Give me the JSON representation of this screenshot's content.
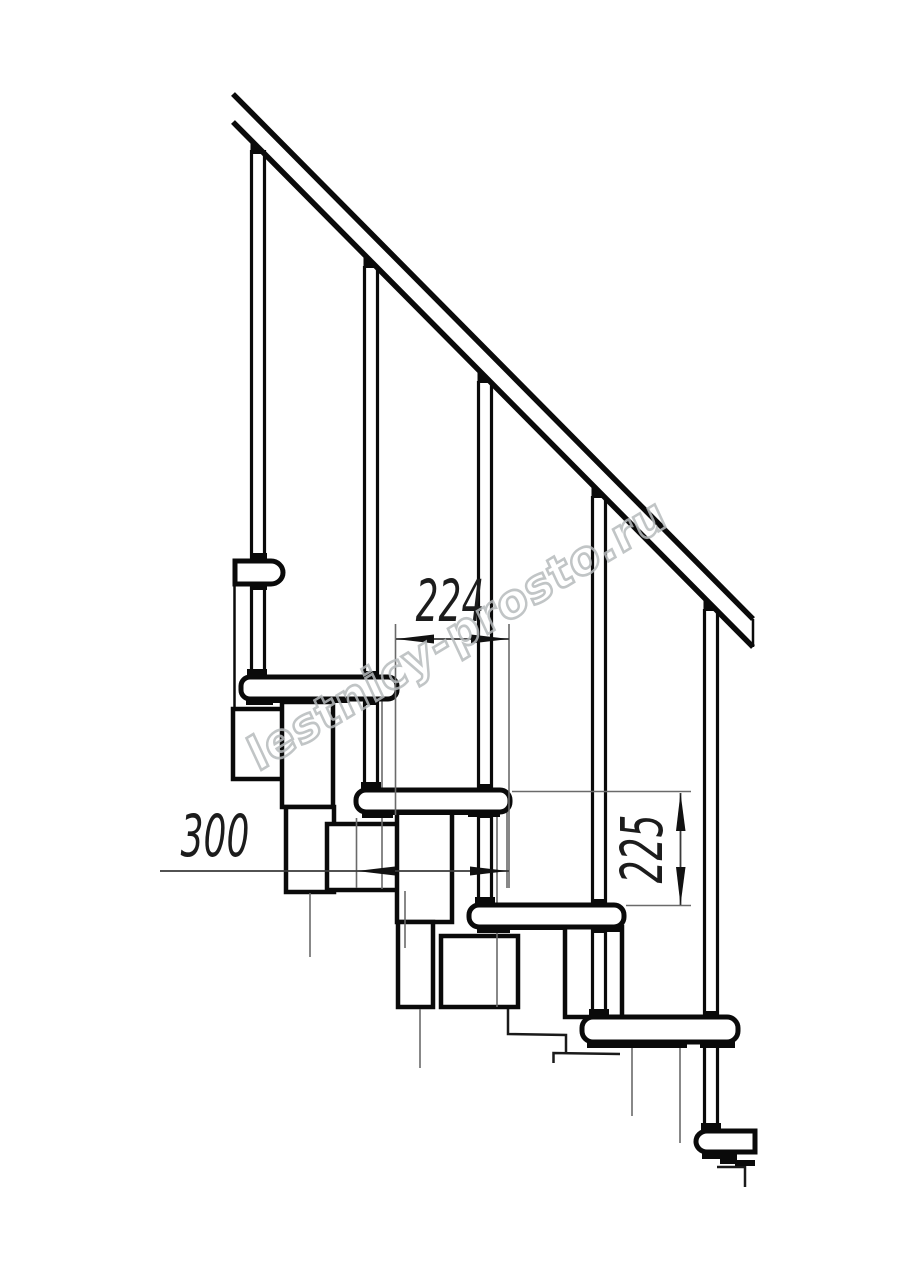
{
  "drawing": {
    "dimensions": {
      "step_offset": {
        "value": "224"
      },
      "tread_depth": {
        "value": "300"
      },
      "riser_height": {
        "value": "225"
      }
    },
    "watermark": {
      "text": "lestnicy-prosto.ru"
    },
    "colors": {
      "line": "#0a0a0a",
      "thin_line": "#6a6a6a",
      "dimension_line": "#3a3a3a",
      "watermark": "#b7bbbd",
      "background": "#ffffff"
    }
  }
}
